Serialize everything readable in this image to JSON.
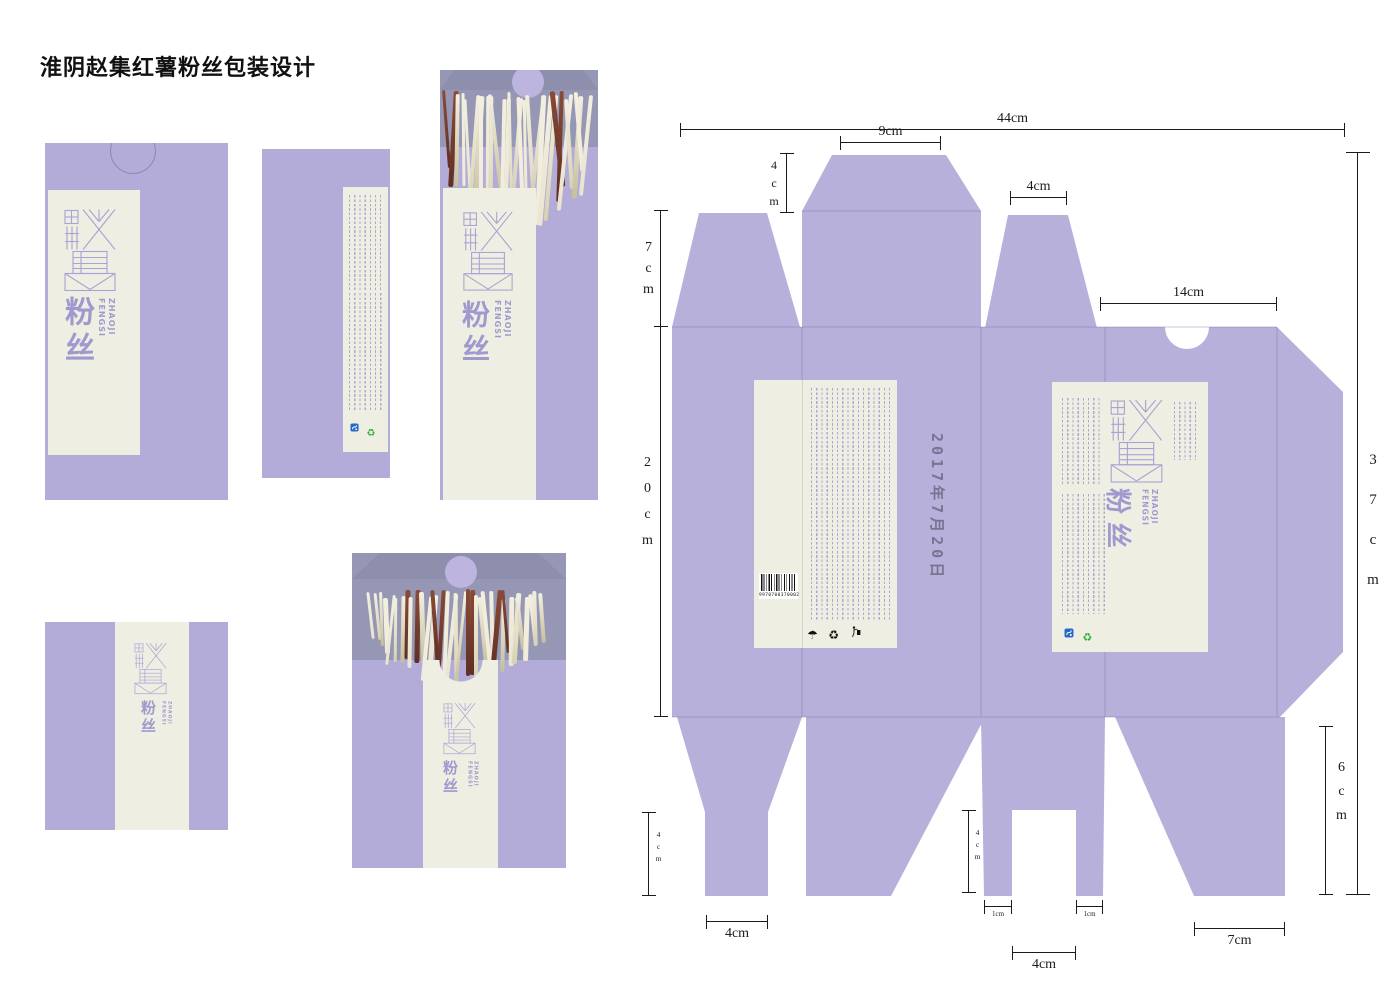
{
  "page": {
    "title": "淮阴赵集红薯粉丝包装设计"
  },
  "brand": {
    "logo_characters": "赵集",
    "product": "粉丝",
    "latin1": "ZHAOJI",
    "latin2": "FENGSI"
  },
  "stamp": {
    "date": "2017年7月20日"
  },
  "barcode": {
    "digits": "9970700370002"
  },
  "dims": {
    "total_width": "44cm",
    "lid_top_width": "9cm",
    "lid_top_height": "4cm",
    "top_left_flap_height": "7cm",
    "top_small_flap_width": "4cm",
    "front_panel_top_width": "14cm",
    "body_height": "20cm",
    "total_height": "37cm",
    "bottom_left_stem_height": "4cm",
    "bottom_left_stem_width": "4cm",
    "bottom_mid_stem_height": "4cm",
    "bottom_mid_stem_left_width": "1cm",
    "bottom_mid_stem_right_width": "1cm",
    "bottom_mid_gap_width": "4cm",
    "bottom_right_flap_width": "7cm",
    "bottom_right_flap_height": "6cm"
  },
  "icons": {
    "umbrella_keep_dry": "☂",
    "recycle_black": "♻",
    "recycle_green": "♻"
  },
  "colors": {
    "page_bg": "#ffffff",
    "lavender": "#b3acd8",
    "lavender_dieline": "#b7b0db",
    "slate_lid": "#9597b5",
    "slate_lid_top": "#8d8fad",
    "tab_lavender": "#bdb4df",
    "cream": "#efeee2",
    "logo_purple": "#a9a2d4",
    "text_purple": "#a099cf",
    "fineprint_purple": "#a39bd1",
    "dim_color": "#1b1b1b",
    "icon_blue": "#2469c8",
    "icon_green": "#2fae3e",
    "noodle_light": "#e9e4cf",
    "noodle_dark_red": "#8a4a36"
  }
}
